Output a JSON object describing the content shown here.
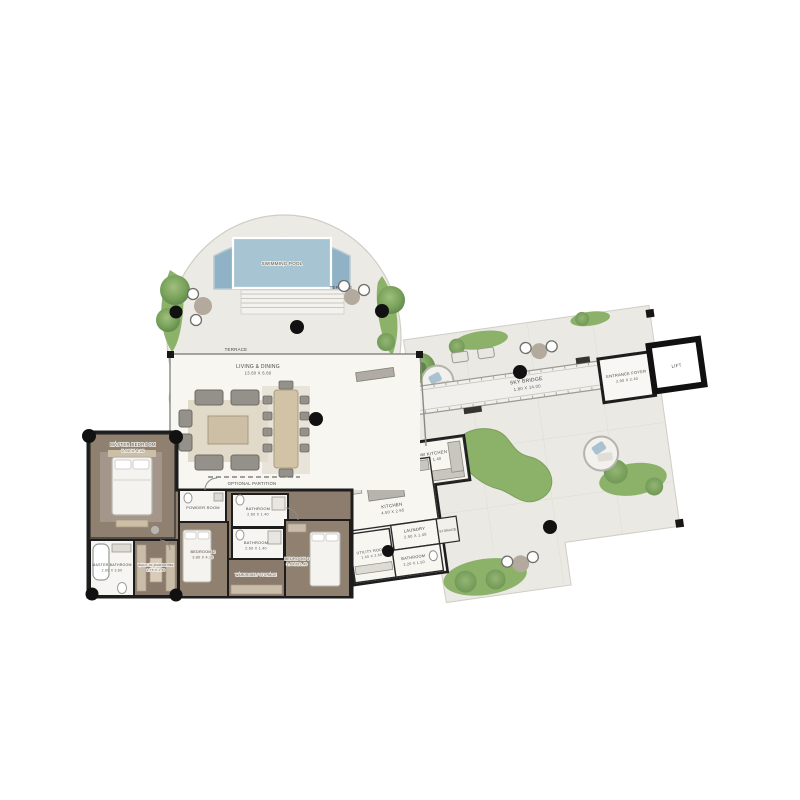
{
  "rooms": {
    "swimming_pool": {
      "name": "SWIMMING POOL"
    },
    "terrace_upper": {
      "name": "TERRACE"
    },
    "terrace_lower": {
      "name": "TERRACE"
    },
    "living_dining": {
      "name": "LIVING & DINING",
      "dims": "13.60 X 6.60"
    },
    "optional_partition": {
      "name": "OPTIONAL PARTITION"
    },
    "master_bedroom": {
      "name": "MASTER BEDROOM",
      "dims": "5.90 X 4.20"
    },
    "master_bathroom": {
      "name": "MASTER BATHROOM",
      "dims": "2.60 X 3.60"
    },
    "walk_in_wardrobe": {
      "name": "WALK-IN WARDROBE",
      "dims": "2.75 X 1.90"
    },
    "powder_room": {
      "name": "POWDER ROOM"
    },
    "bathroom_2": {
      "name": "BATHROOM",
      "dims": "2.60 X 1.40"
    },
    "bathroom_3": {
      "name": "BATHROOM",
      "dims": "2.60 X 1.40"
    },
    "wardrobe_storage": {
      "name": "WARDROBE / STORAGE"
    },
    "bedroom_2": {
      "name": "BEDROOM 2",
      "dims": "3.80 X 4.10"
    },
    "bedroom_3": {
      "name": "BEDROOM 3",
      "dims": "3.60 X 3.40"
    },
    "show_kitchen": {
      "name": "SHOW KITCHEN",
      "dims": "2.95 X 1.40"
    },
    "kitchen": {
      "name": "KITCHEN",
      "dims": "4.50 X 2.95"
    },
    "laundry": {
      "name": "LAUNDRY",
      "dims": "2.50 X 1.40"
    },
    "utility_room": {
      "name": "UTILITY ROOM",
      "dims": "1.40 X 2.60"
    },
    "bathroom_utility": {
      "name": "BATHROOM",
      "dims": "2.20 X 1.50"
    },
    "storage": {
      "name": "STORAGE"
    },
    "sky_bridge": {
      "name": "SKY BRIDGE",
      "dims": "1.80 X 14.00"
    },
    "entrance_foyer": {
      "name": "ENTRANCE FOYER",
      "dims": "2.90 X 2.40"
    },
    "lift": {
      "name": "LIFT"
    }
  },
  "colors": {
    "pool": "#8fb2c6",
    "pool_inner": "#a7c4d3",
    "lawn": "#8cb169",
    "tree": "#6b9450",
    "stone": "#ecebe5",
    "interior_floor": "#f7f6f1",
    "bedroom_floor": "#8d7d6f",
    "wall": "#1d1d1d",
    "furniture_gray": "#9a968f",
    "accent_beige": "#d2c3a6"
  }
}
